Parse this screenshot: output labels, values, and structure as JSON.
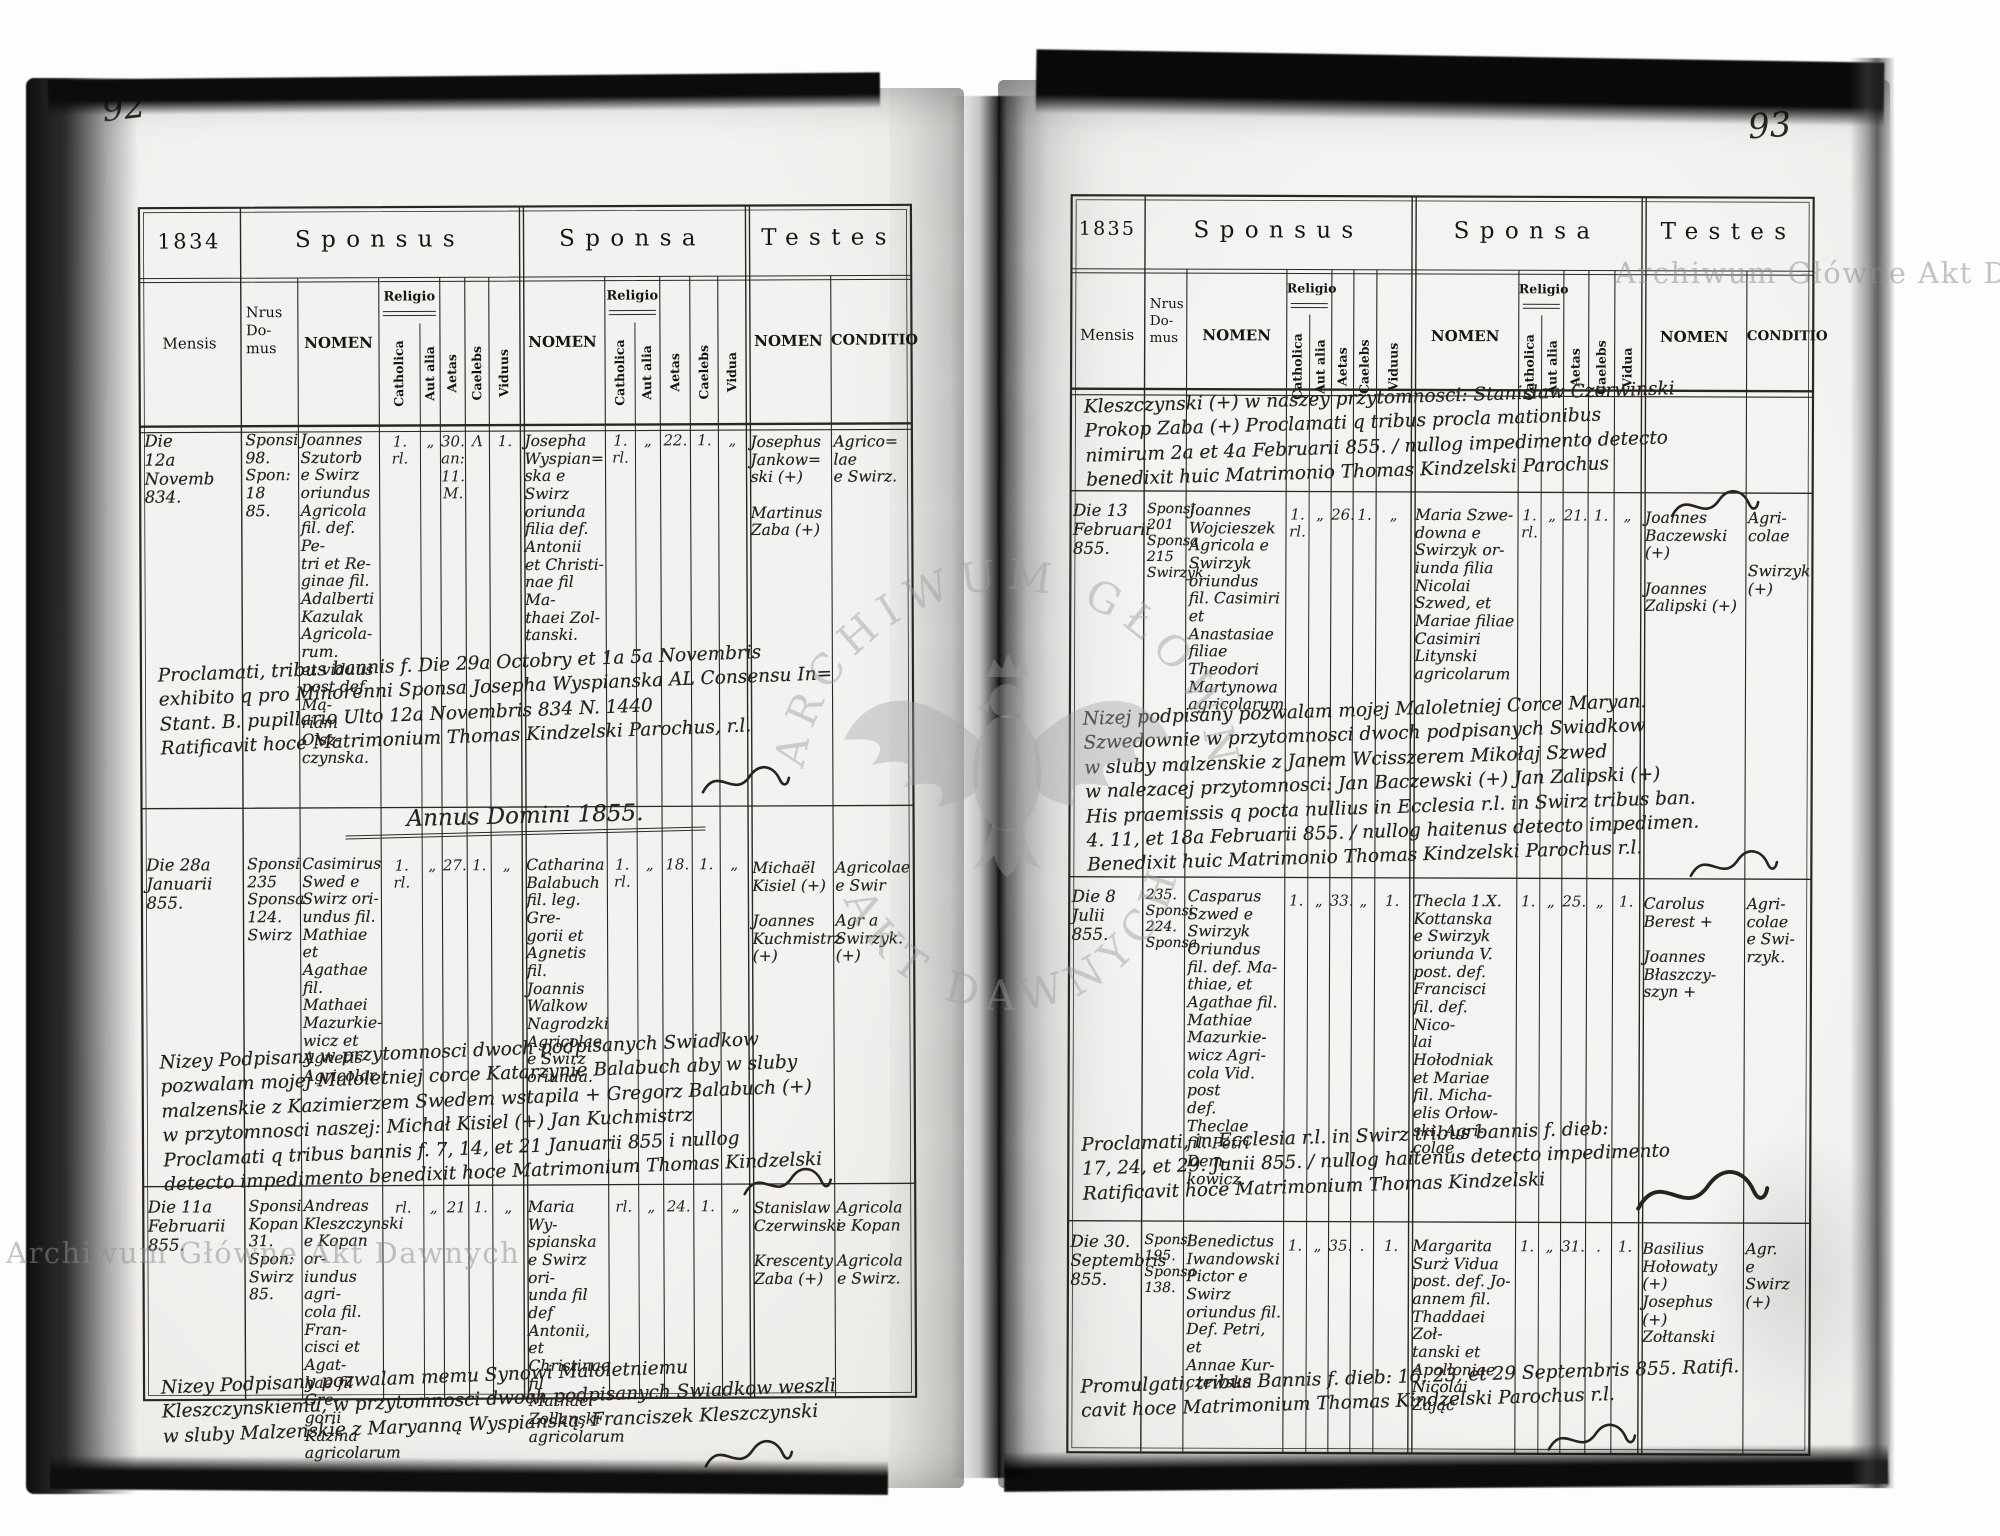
{
  "document": {
    "archive_watermark": "Archiwum Główne Akt Dawnych",
    "watermark_arc_top": "ARCHIWUM GŁÓWNE",
    "watermark_arc_bottom": "AKT DAWNYCH"
  },
  "labels": {
    "sponsus": "Sponsus",
    "sponsa": "Sponsa",
    "testes": "Testes",
    "mensis": "Mensis",
    "nrus": "Nrus\nDo-\nmus",
    "nomen": "NOMEN",
    "religio": "Religio",
    "catholica": "Catholica",
    "aut_alia": "Aut alia",
    "aetas": "Aetas",
    "caelebs": "Caelebs",
    "viduus": "Viduus",
    "vidua": "Vidua",
    "conditio": "CONDITIO"
  },
  "left": {
    "page_number": "92",
    "year": "1834",
    "annus_heading": "Annus Domini 1855.",
    "entries": [
      {
        "mensis": "Die\n12a\nNovemb\n834.",
        "nrus": "Sponsi\n98.\nSpon:\n18\n85.",
        "groom": "Joannes\nSzutorb\ne Swirz\noriundus\nAgricola\nfil. def. Pe-\ntri et Re-\nginae fil.\nAdalberti\nKazulak\nAgricola-\nrum.\net viduus\npost def. Ma-\nriam Olsz-\nczynska.",
        "groom_ticks": [
          "1.\nrl.",
          "„",
          "30.\nan:\n11.\nM.",
          "Λ",
          "1."
        ],
        "bride": "Josepha\nWyspian=\nska e\nSwirz\noriunda\nfilia def.\nAntonii\net Christi-\nnae fil Ma-\nthaei Zol-\ntanski.",
        "bride_ticks": [
          "1.\nrl.",
          "„",
          "22.",
          "1.",
          "„"
        ],
        "witnesses": "Josephus\nJankow=\nski (+)\n\nMartinus\nZaba (+)",
        "conditio": "Agrico=\nlae\ne Swirz."
      },
      {
        "mensis": "Die 28a\nJanuarii\n855.",
        "nrus": "Sponsi\n235\nSponsa\n124.\nSwirz",
        "groom": "Casimirus\nSwed e\nSwirz ori-\nundus fil.\nMathiae et\nAgathae fil.\nMathaei\nMazurkie-\nwicz et\nAgnetis\nAgricolar.",
        "groom_ticks": [
          "1.\nrl.",
          "„",
          "27.",
          "1.",
          "„"
        ],
        "bride": "Catharina\nBalabuch\nfil. leg. Gre-\ngorii et\nAgnetis fil.\nJoannis\nWalkow\nNagrodzki\nAgricolae\ne Swirz\noriunda.",
        "bride_ticks": [
          "1.\nrl.",
          "„",
          "18.",
          "1.",
          "„"
        ],
        "witnesses": "Michaël\nKisiel (+)\n\nJoannes\nKuchmistrz\n(+)",
        "conditio": "Agricolae\ne Swir\n\nAgr a\nSwirzyk.\n(+)"
      },
      {
        "mensis": "Die 11a\nFebruarii\n855.",
        "nrus": "Sponsi\nKopan\n31.\nSpon:\nSwirz\n85.",
        "groom": "Andreas\nKleszczynski\ne Kopan or-\niundus agri-\ncola fil. Fran-\ncisci et Agat-\nhae fil Gre-\ngorii Kazma\nagricolarum",
        "groom_ticks": [
          "rl.",
          "„",
          "21",
          "1.",
          "„"
        ],
        "bride": "Maria Wy-\nspianska\ne Swirz ori-\nunda fil def\nAntonii,\net Christinae\nfil Mathaei\nZollanski\nagricolarum",
        "bride_ticks": [
          "rl.",
          "„",
          "24.",
          "1.",
          "„"
        ],
        "witnesses": "Stanislaw\nCzerwinski\n\nKrescenty\nZaba (+)",
        "conditio": "Agricola\ne Kopan\n\nAgricola\ne Swirz."
      }
    ],
    "notes": [
      "Proclamati, tribus bannis f. Die 29a Octobry et 1a 5a Novembris\nexhibito q pro Minorenni Sponsa Josepha Wyspianska AL Consensu In=\nStant. B. pupillario Ulto 12a Novembris 834 N. 1440\nRatificavit hoce Matrimonium Thomas Kindzelski Parochus, r.l.",
      "Nizey Podpisany w przytomnosci dwoch podpisanych Swiadkow\npozwalam mojej Maloletniej corce Katarzynie Balabuch aby w sluby\nmalzenskie z Kazimierzem Swedem wstapila + Gregorz Balabuch (+)\nw przytomnosci naszej: Michał Kisiel (+) Jan Kuchmistrz\nProclamati q tribus bannis f. 7, 14, et 21 Januarii 855 i nullog\ndetecto impedimento benedixit hoce Matrimonium Thomas Kindzelski",
      "Nizey Podpisany pozwalam memu Synowi Maloletniemu\nKleszczynskiemu, w przytomnosci dwoch podpisanych Swiadkow weszli\nw sluby Malzenskie z Maryanną Wyspianską, Franciszek Kleszczynski"
    ]
  },
  "right": {
    "page_number": "93",
    "year": "1835",
    "entries": [
      {
        "mensis": "Die 13\nFebruarii\n855.",
        "nrus": "Sponsi\n201\nSponsa\n215\nSwirzyk",
        "groom": "Joannes\nWojcieszek\nAgricola e\nSwirzyk\noriundus\nfil. Casimiri\net Anastasiae\nfiliae Theodori\nMartynowa\nagricolarum",
        "groom_ticks": [
          "1.\nrl.",
          "„",
          "26.",
          "1.",
          "„"
        ],
        "bride": "Maria Szwe-\ndowna e\nSwirzyk or-\niunda filia\nNicolai\nSzwed, et\nMariae filiae\nCasimiri\nLitynski\nagricolarum",
        "bride_ticks": [
          "1.\nrl.",
          "„",
          "21.",
          "1.",
          "„"
        ],
        "witnesses": "Joannes\nBaczewski (+)\n\nJoannes\nZalipski (+)",
        "conditio": "Agri-\ncolae\n\nSwirzyk\n(+)"
      },
      {
        "mensis": "Die 8\nJulii\n855.",
        "nrus": "235.\nSponsi\n224.\nSponsa",
        "groom": "Casparus\nSzwed e\nSwirzyk\nOriundus\nfil. def. Ma-\nthiae, et\nAgathae fil.\nMathiae\nMazurkie-\nwicz Agri-\ncola Vid. post\ndef. Theclae\nfil. Petri Dem-\nkowicz.",
        "groom_ticks": [
          "1.",
          "„",
          "33.",
          "„",
          "1."
        ],
        "bride": "Thecla 1.X.\nKottanska\ne Swirzyk\noriunda V.\npost. def.\nFrancisci\nfil. def. Nico-\nlai Hołodniak\net Mariae\nfil. Micha-\nelis Orłow-\nski. Agri-\ncolae",
        "bride_ticks": [
          "1.",
          "„",
          "25.",
          "„",
          "1."
        ],
        "witnesses": "Carolus\nBerest +\n\nJoannes\nBłaszczy-\nszyn +",
        "conditio": "Agri-\ncolae\ne Swi-\nrzyk."
      },
      {
        "mensis": "Die 30.\nSeptembris\n855.",
        "nrus": "Sponsi\n195.\nSponsa\n138.",
        "groom": "Benedictus\nIwandowski\nPictor e Swirz\noriundus fil.\nDef. Petri, et\nAnnae Kur-\nczewska",
        "groom_ticks": [
          "1.",
          "„",
          "35.",
          ".",
          "1."
        ],
        "bride": "Margarita\nSurż Vidua\npost. def. Jo-\nannem fil.\nThaddaei Zoł-\ntanski et\nApolloniae\nNicolai Zając",
        "bride_ticks": [
          "1.",
          "„",
          "31.",
          ".",
          "1."
        ],
        "witnesses": "Basilius\nHołowaty\n(+)\nJosephus\n(+)\nZołtanski",
        "conditio": "Agr.\ne\nSwirz\n(+)"
      }
    ],
    "notes": [
      "Kleszczynski (+) w naszey przytomnosci: Stanisław Czerwinski\nProkop Zaba (+)   Proclamati q tribus procla mationibus\nnimirum 2a et 4a Februarii 855. / nullog impedimento detecto\nbenedixit huic Matrimonio Thomas Kindzelski Parochus",
      "Nizej podpisany pozwalam mojej Maloletniej Corce Maryan.\nSzwedownie w przytomnosci dwoch podpisanych Swiadkow\nw sluby malzenskie z Janem Wcisszerem  Mikołaj Szwed\nw nalezacej przytomnosci: Jan Baczewski (+) Jan Zalipski (+)\nHis praemissis q pocta nullius in Ecclesia r.l. in Swirz tribus ban.\n4. 11, et 18a Februarii 855. / nullog haitenus detecto impedimen.\nBenedixit huic Matrimonio Thomas Kindzelski Parochus r.l.",
      "Proclamati, in Ecclesia r.l. in Swirz tribus bannis f. dieb:\n17, 24, et 29. Junii 855. / nullog haitenus detecto impedimento\nRatificavit hoce Matrimonium Thomas Kindzelski",
      "Promulgati, tribus Bannis f. dieb: 16, 23, et 29 Septembris 855. Ratifi.\ncavit hoce Matrimonium Thomas Kindzelski Parochus r.l."
    ]
  }
}
